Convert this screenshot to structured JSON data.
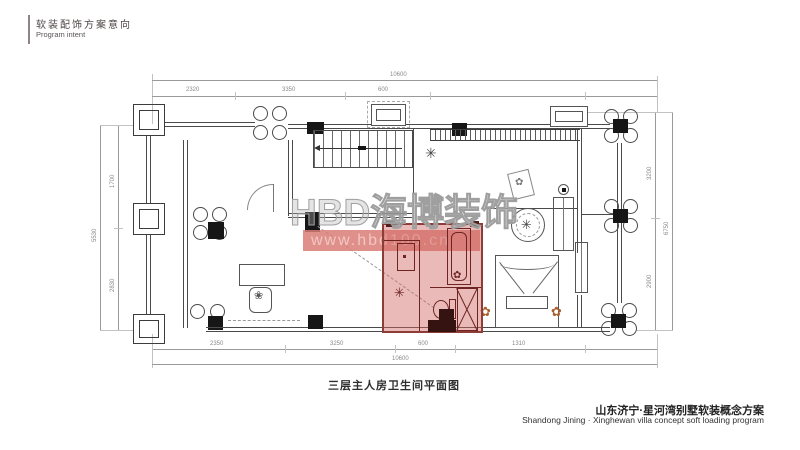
{
  "header": {
    "title_cn": "软装配饰方案意向",
    "title_en": "Program intent"
  },
  "watermark": {
    "logo": "HBD海博装饰",
    "url": "www.hbd100.cn"
  },
  "plan": {
    "caption": "三层主人房卫生间平面图",
    "dimensions": {
      "top": {
        "segments": [
          "2320",
          "3350",
          "600"
        ],
        "overall": "10600"
      },
      "bottom": {
        "segments": [
          "2350",
          "3250",
          "600",
          "1310"
        ],
        "overall": "10600"
      },
      "left": {
        "segments": [
          "1700",
          "2830"
        ],
        "overall": "5530"
      },
      "right": {
        "segments": [
          "3200",
          "2900"
        ],
        "overall": "6750"
      }
    },
    "symbols": {
      "snowflake": "✳",
      "flower": "✿",
      "plant": "❀"
    },
    "highlight": {
      "area": "master-bathroom",
      "fill": "rgba(206,103,98,0.45)",
      "border": "#8e3c37"
    }
  },
  "footer": {
    "project_cn": "山东济宁·星河湾别墅软装概念方案",
    "project_en": "Shandong Jining · Xinghewan villa concept soft loading program"
  }
}
